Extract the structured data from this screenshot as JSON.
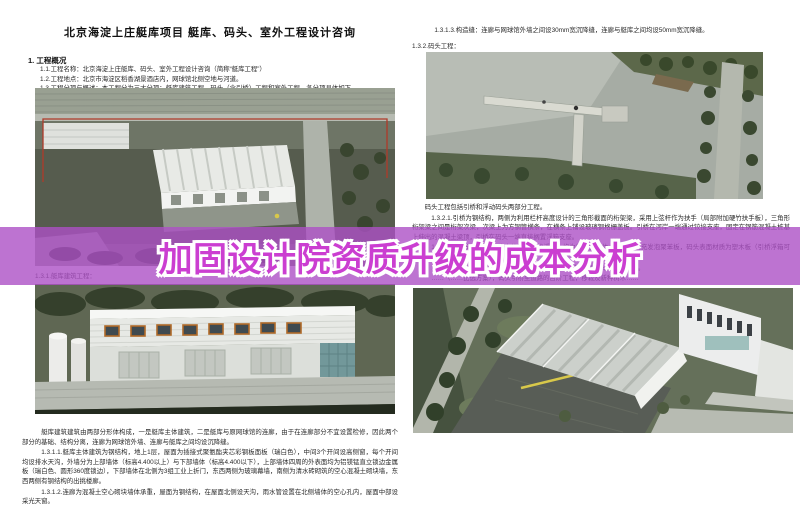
{
  "header": {
    "title": "北京海淀上庄艇库项目 艇库、码头、室外工程设计咨询"
  },
  "overlay_banner": {
    "title": "加固设计院资质升级的成本分析",
    "band_color": "#ad50c6",
    "text_fill": "#cb3ed1",
    "text_stroke": "#ffffff"
  },
  "left_column": {
    "section_heading": "1.  工程概况",
    "intro_lines": [
      "1.1.工程名称：北京海淀上庄艇库、码头、室外工程设计咨询（简称“艇库工程”）",
      "1.2.工程地点：北京市海淀区稻香湖景酒店内，网球馆北侧空地与河道。",
      "1.3.工程分项与概述：本工程分为三大分项：艇库建筑工程、码头（含引桥）工程和室外工程，各分项具体如下。"
    ],
    "figure_caption": "1.3.1.艇库建筑工程：",
    "paragraphs": [
      "艇库建筑建筑由两部分形体构成，一是艇库主体建筑，二是艇库与原网球馆的连廊，由于在连廊部分不宜设置检修，因此两个部分的基础、结构分离，连廊为网球馆外墙、连廊与艇库之间均设沉降缝。",
      "1.3.1.1.艇库主体建筑为钢结构，地上1层，屋面为插接式聚氨酯夹芯彩钢板面板（瑞白色），中间3个开间设高侧窗，每个开间均设排水天沟，外墙分为上部墙体（标高4.400以上）与下部墙体（标高4.400以下），上部墙体四周的外表面均为铝镁锰直立锁边金属板（瑞白色、圆形360度锁边），下部墙体在北侧为3组工业上折门，东西两侧为玻璃幕墙，南侧为清水砖砌筑的空心混凝土砌块墙，东西两侧有钢结构的出挑楼廊。",
      "1.3.1.2.连廊为混凝土空心砌块墙体承重，屋面为钢结构，在屋面北侧设天沟，雨水管设置在北侧墙体的空心孔内，屋面中部设采光天窗。"
    ]
  },
  "right_column": {
    "top_lines": [
      "1.3.1.3.构造缝：连廊与网球馆外墙之间设30mm宽沉降缝，连廊与艇库之间均设50mm宽沉降缝。",
      "1.3.2.码头工程："
    ],
    "paragraphs": [
      "码头工程包括引桥和浮动码头两部分工程。",
      "1.3.2.1.引桥为钢结构，两侧为利用栏杆高度设计的三角形截面的桁架梁，采用上弦杆作为扶手（局部附加硬竹扶手板），三角形桁架梁之间是桁架次梁，次梁上为方钢管横条，在横条上铺设玻璃钢格栅盖板。引桥在河岸一端通过铰接支座，固定在钢筋混凝土桩基上伸出的混凝土梁顶，引桥在码头一端直接搁置浮箱支座。",
      "1.3.2.2.浮动码头包括码头本体及引桥的浮箱，均为铝合金箱体，箱体内填充发泡聚苯板，码头表面材质为塑木板（引桥浮箱可不做面层）。",
      "1.3.2.3.固定桩：码头两端各设一个固定桩，通过抱箍限定码头的水平位移。",
      "……（……比选方案），码头引桥至道路的台阶工程，移栽及新种树木……"
    ]
  }
}
